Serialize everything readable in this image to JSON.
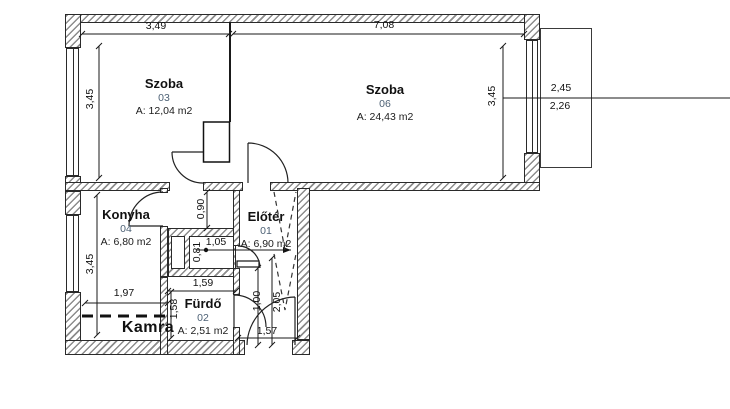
{
  "plan_type": "apartment floor plan",
  "rooms": {
    "szoba03": {
      "name": "Szoba",
      "number": "03",
      "area": "A: 12,04 m2"
    },
    "szoba06": {
      "name": "Szoba",
      "number": "06",
      "area": "A: 24,43 m2"
    },
    "konyha": {
      "name": "Konyha",
      "number": "04",
      "area": "A: 6,80 m2"
    },
    "eloter": {
      "name": "Előtér",
      "number": "01",
      "area": "A: 6,90 m2"
    },
    "furdo": {
      "name": "Fürdő",
      "number": "02",
      "area": "A: 2,51 m2"
    },
    "kamra": {
      "name": "Kamra"
    }
  },
  "dims": {
    "szoba03_width": "3,49",
    "szoba06_width": "7,08",
    "left_height": "3,45",
    "right_height": "3,45",
    "balcony_outer": "2,45",
    "balcony_inner": "2,26",
    "konyha_height": "3,45",
    "konyha_width": "1,97",
    "corridor_depth": "0,90",
    "shaft_width": "1,05",
    "shaft_depth": "0,81",
    "furdo_width": "1,59",
    "furdo_height": "1,58",
    "hall_width_a": "1,00",
    "hall_width_b": "2,05",
    "entrance_width": "1,57"
  },
  "colors": {
    "wall_line": "#2a2a2a",
    "wall_hatch": "#8c8c8c",
    "room_number_text": "#4d6175",
    "background": "#ffffff"
  }
}
